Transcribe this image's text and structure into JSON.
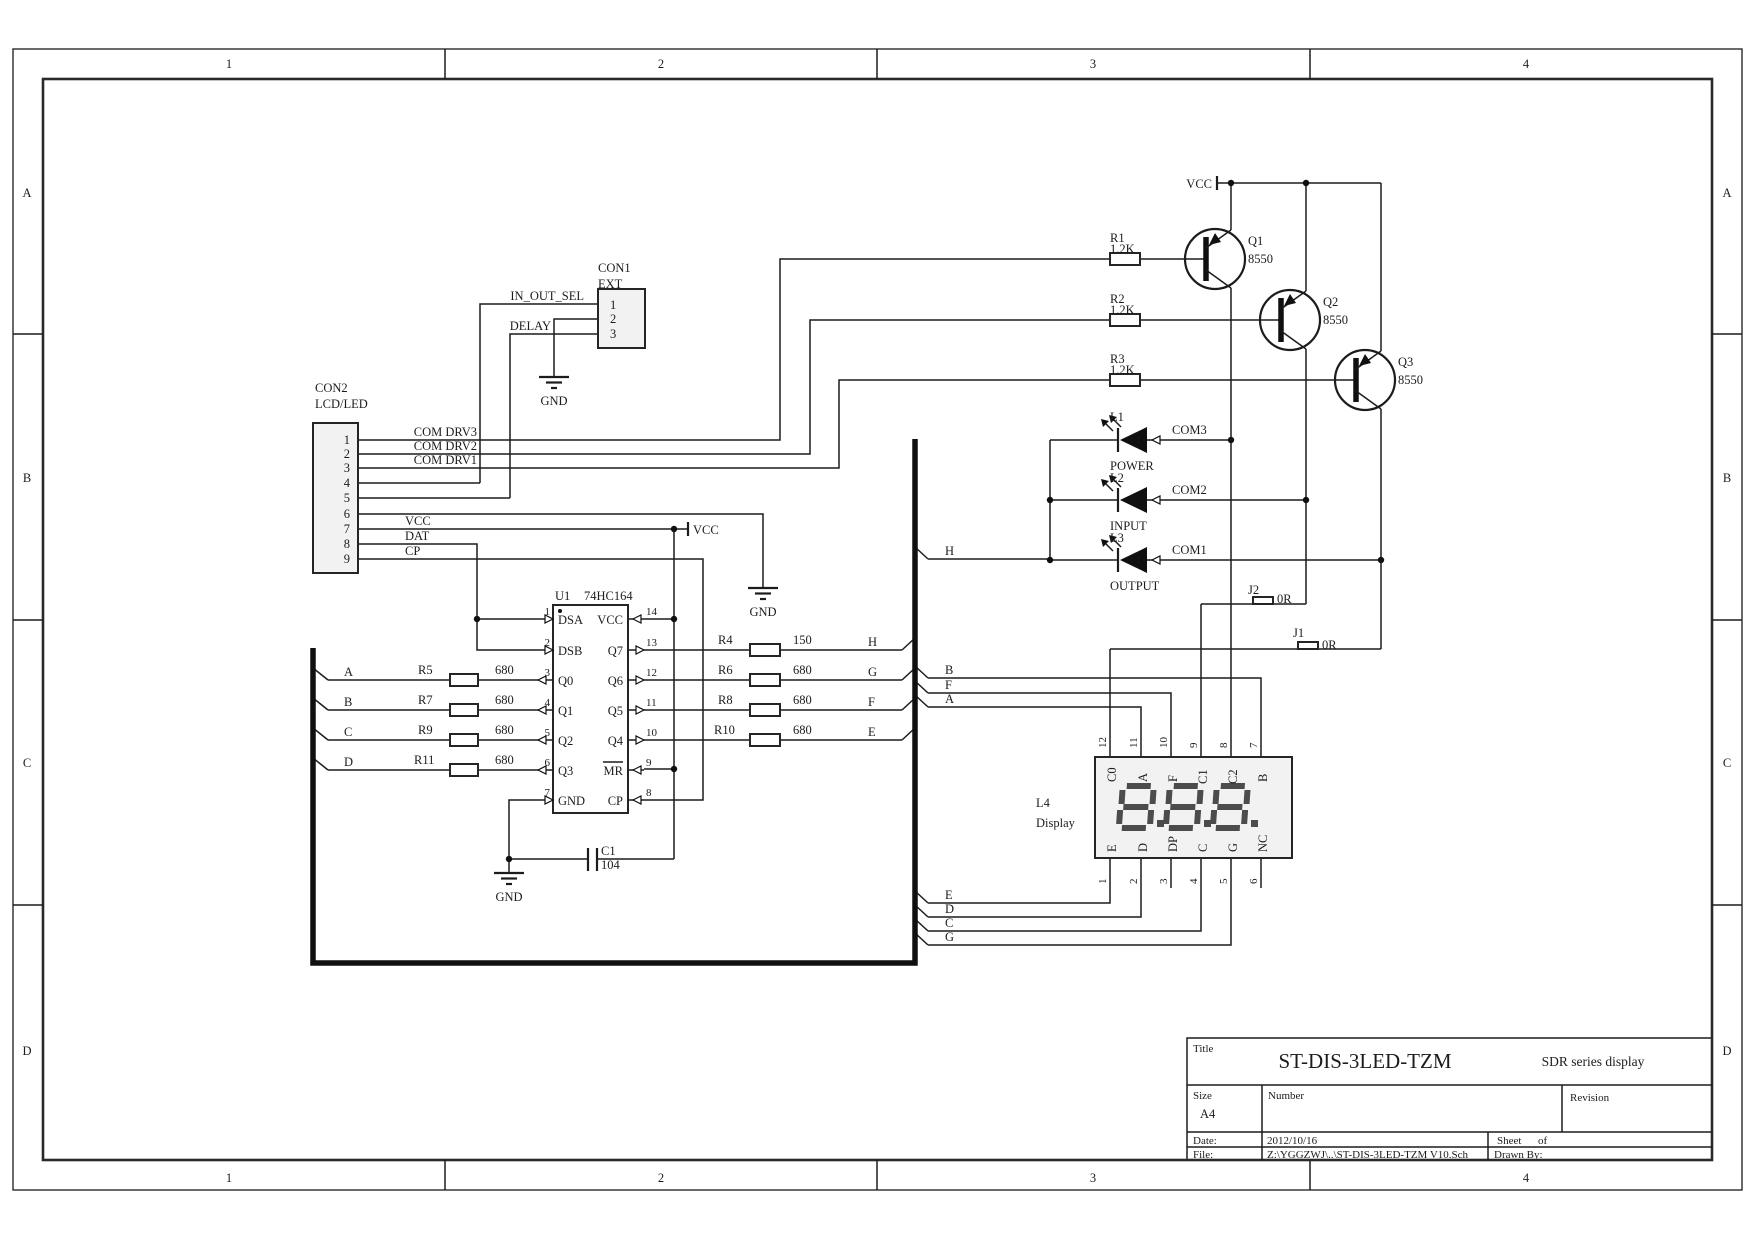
{
  "frame": {
    "columns": [
      "1",
      "2",
      "3",
      "4"
    ],
    "rows": [
      "A",
      "B",
      "C",
      "D"
    ]
  },
  "power": {
    "vcc": "VCC",
    "gnd": "GND"
  },
  "con1": {
    "ref": "CON1",
    "name": "EXT",
    "pins": [
      "1",
      "2",
      "3"
    ],
    "net1": "IN_OUT_SEL",
    "net3": "DELAY"
  },
  "con2": {
    "ref": "CON2",
    "name": "LCD/LED",
    "pins": [
      "1",
      "2",
      "3",
      "4",
      "5",
      "6",
      "7",
      "8",
      "9"
    ],
    "nets": {
      "p1": "COM DRV3",
      "p2": "COM DRV2",
      "p3": "COM DRV1",
      "p7": "VCC",
      "p8": "DAT",
      "p9": "CP"
    }
  },
  "u1": {
    "ref": "U1",
    "part": "74HC164",
    "left": [
      {
        "n": "1",
        "name": "DSA"
      },
      {
        "n": "2",
        "name": "DSB"
      },
      {
        "n": "3",
        "name": "Q0"
      },
      {
        "n": "4",
        "name": "Q1"
      },
      {
        "n": "5",
        "name": "Q2"
      },
      {
        "n": "6",
        "name": "Q3"
      },
      {
        "n": "7",
        "name": "GND"
      }
    ],
    "right": [
      {
        "n": "14",
        "name": "VCC"
      },
      {
        "n": "13",
        "name": "Q7"
      },
      {
        "n": "12",
        "name": "Q6"
      },
      {
        "n": "11",
        "name": "Q5"
      },
      {
        "n": "10",
        "name": "Q4"
      },
      {
        "n": "9",
        "name": "MR"
      },
      {
        "n": "8",
        "name": "CP"
      }
    ]
  },
  "resistors": {
    "r1": {
      "ref": "R1",
      "value": "1.2K"
    },
    "r2": {
      "ref": "R2",
      "value": "1.2K"
    },
    "r3": {
      "ref": "R3",
      "value": "1.2K"
    },
    "r4": {
      "ref": "R4",
      "value": "150"
    },
    "r5": {
      "ref": "R5",
      "value": "680"
    },
    "r6": {
      "ref": "R6",
      "value": "680"
    },
    "r7": {
      "ref": "R7",
      "value": "680"
    },
    "r8": {
      "ref": "R8",
      "value": "680"
    },
    "r9": {
      "ref": "R9",
      "value": "680"
    },
    "r10": {
      "ref": "R10",
      "value": "680"
    },
    "r11": {
      "ref": "R11",
      "value": "680"
    }
  },
  "capacitors": {
    "c1": {
      "ref": "C1",
      "value": "104"
    }
  },
  "jumpers": {
    "j1": {
      "ref": "J1",
      "value": "0R"
    },
    "j2": {
      "ref": "J2",
      "value": "0R"
    }
  },
  "transistors": {
    "q1": {
      "ref": "Q1",
      "part": "8550"
    },
    "q2": {
      "ref": "Q2",
      "part": "8550"
    },
    "q3": {
      "ref": "Q3",
      "part": "8550"
    }
  },
  "leds": {
    "l1": {
      "ref": "L1",
      "name": "POWER",
      "net": "COM3"
    },
    "l2": {
      "ref": "L2",
      "name": "INPUT",
      "net": "COM2"
    },
    "l3": {
      "ref": "L3",
      "name": "OUTPUT",
      "net": "COM1"
    }
  },
  "display": {
    "ref": "L4",
    "name": "Display",
    "top_pins": [
      {
        "n": "12",
        "name": "C0"
      },
      {
        "n": "11",
        "name": "A"
      },
      {
        "n": "10",
        "name": "F"
      },
      {
        "n": "9",
        "name": "C1"
      },
      {
        "n": "8",
        "name": "C2"
      },
      {
        "n": "7",
        "name": "B"
      }
    ],
    "bottom_pins": [
      {
        "n": "1",
        "name": "E"
      },
      {
        "n": "2",
        "name": "D"
      },
      {
        "n": "3",
        "name": "DP"
      },
      {
        "n": "4",
        "name": "C"
      },
      {
        "n": "5",
        "name": "G"
      },
      {
        "n": "6",
        "name": "NC"
      }
    ]
  },
  "bus": {
    "left_entries": [
      "A",
      "B",
      "C",
      "D"
    ],
    "right_entries": [
      "H",
      "G",
      "F",
      "E"
    ],
    "h_exit": "H",
    "mid_exits": [
      "B",
      "F",
      "A"
    ],
    "bottom_exits": [
      "E",
      "D",
      "C",
      "G"
    ]
  },
  "title_block": {
    "title_label": "Title",
    "title": "ST-DIS-3LED-TZM",
    "subtitle": "SDR series display",
    "size_label": "Size",
    "size": "A4",
    "number_label": "Number",
    "revision_label": "Revision",
    "date_label": "Date:",
    "date": "2012/10/16",
    "sheet_label": "Sheet",
    "of_label": "of",
    "file_label": "File:",
    "file": "Z:\\YGGZWJ\\..\\ST-DIS-3LED-TZM V10.Sch",
    "drawn_label": "Drawn By:"
  }
}
